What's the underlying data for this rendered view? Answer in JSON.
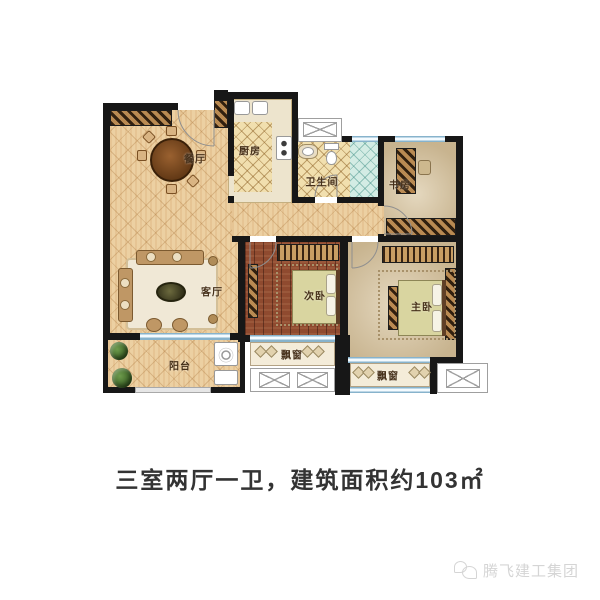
{
  "caption": {
    "text": "三室两厅一卫，建筑面积约103㎡"
  },
  "watermark": {
    "brand": "腾飞建工集团",
    "icon": "chat-bubbles-icon"
  },
  "rooms": {
    "dining": "餐厅",
    "kitchen": "厨房",
    "bathroom": "卫生间",
    "study": "书房",
    "living": "客厅",
    "second_bedroom": "次卧",
    "master_bedroom": "主卧",
    "balcony": "阳台",
    "bay_window_second": "飘窗",
    "bay_window_master": "飘窗"
  },
  "colors": {
    "wall": "#171717",
    "window_blue": "#87b3cc",
    "floor_tile_tan": "#ecd0a2",
    "kitchen_bath_tile": "#f1dfae",
    "shower_tile": "#d3ece4",
    "bedroom_wood": "#8f4a2f",
    "stone_floor": "#d9c7a3",
    "caption_text": "#333333",
    "watermark_gray": "#d5d5d5"
  }
}
